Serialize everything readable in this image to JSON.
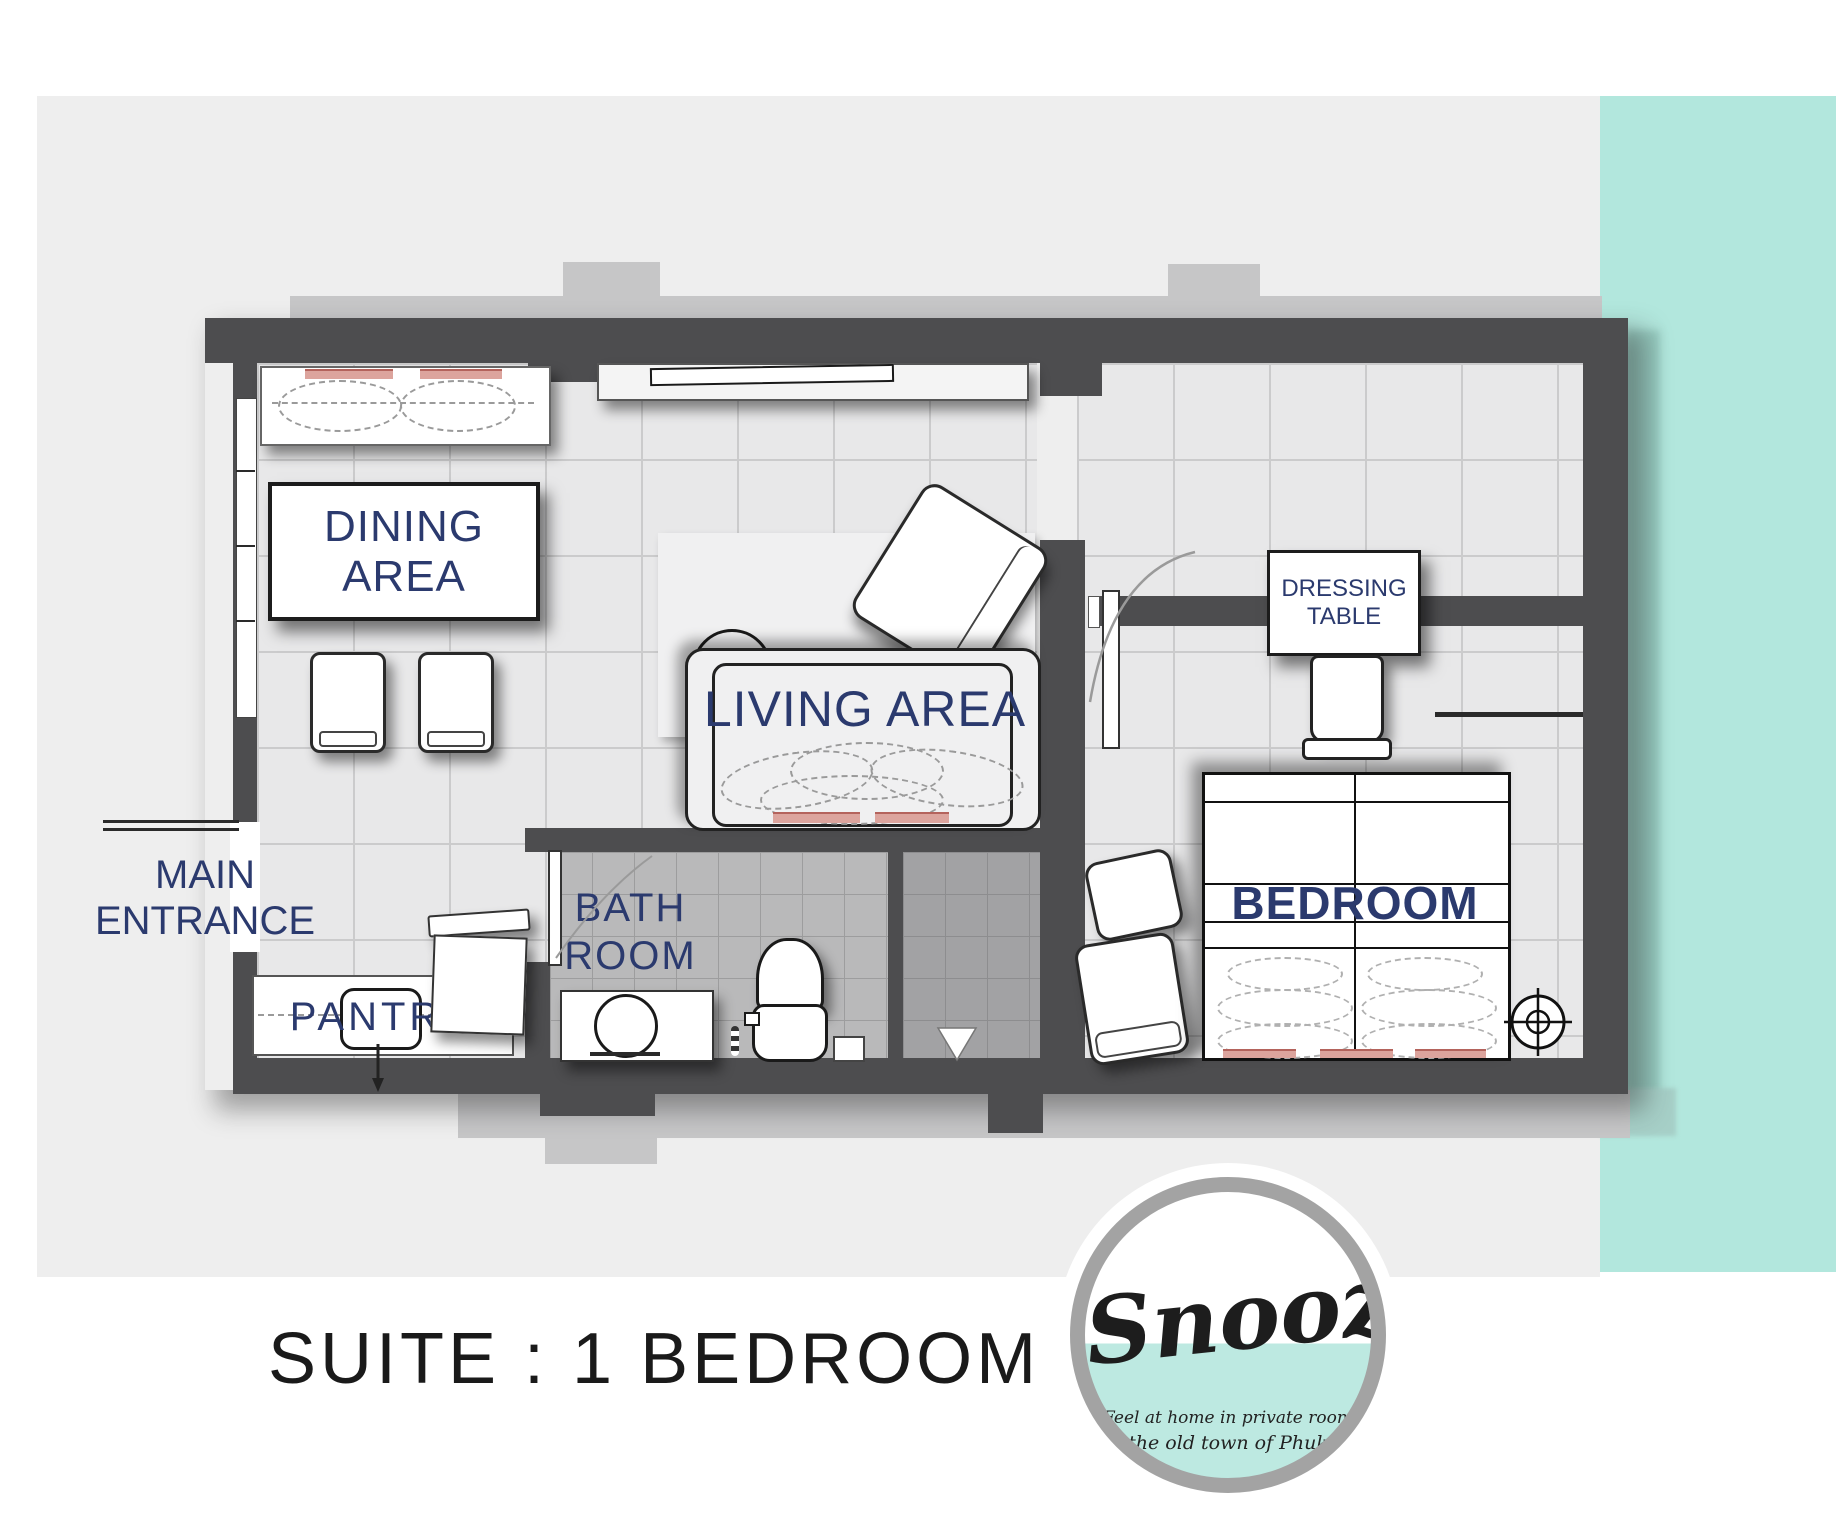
{
  "canvas": {
    "width": 1836,
    "height": 1529
  },
  "colors": {
    "teal_panel": "#b2e7dd",
    "background_gray": "#eeeeee",
    "slab_gray": "#c6c6c7",
    "wall": "#4d4d4f",
    "label_navy": "#2b3a6e",
    "floor_tile": "#e8e8e9",
    "bath_floor": "#b9b9ba",
    "shower_floor": "#a2a2a4",
    "cushion_red": "#dca49d",
    "title_black": "#1a1a1a",
    "logo_ring_gray": "#a3a3a3",
    "logo_teal": "#bde9e1"
  },
  "title": "SUITE : 1 BEDROOM",
  "rooms": {
    "dining": {
      "line1": "DINING",
      "line2": "AREA"
    },
    "living": {
      "label": "LIVING AREA"
    },
    "bathroom": {
      "line1": "BATH",
      "line2": "ROOM"
    },
    "bedroom": {
      "label": "BEDROOM"
    },
    "dressing_table": {
      "line1": "DRESSING",
      "line2": "TABLE"
    },
    "main_entrance": {
      "line1": "MAIN",
      "line2": "ENTRANCE"
    },
    "pantry": {
      "label": "PANTRY"
    }
  },
  "logo": {
    "brand": "Snoozy",
    "tagline1": "Feel at home in private room",
    "tagline2": "at the old town of Phuket."
  }
}
